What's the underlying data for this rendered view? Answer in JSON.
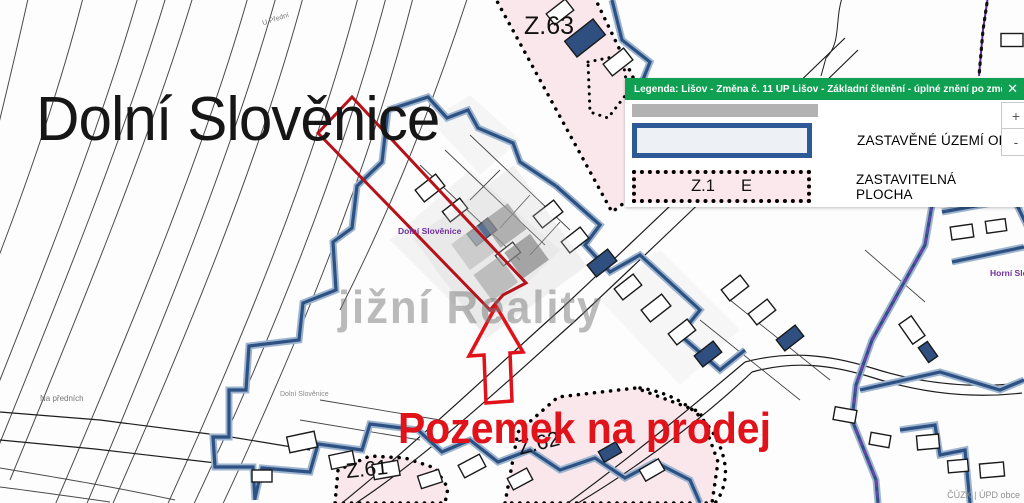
{
  "map": {
    "title_label": "Dolní Slověnice",
    "for_sale_text": "Pozemek na prodej",
    "watermark_text": "jižní Reality",
    "attribution": "ČÚZK | ÚPD obce",
    "labels": {
      "u_predni": "U Přední",
      "na_prednich": "Na předních",
      "village_purple": "Dolní Slověnice",
      "village_gray": "Dolní Slověnice",
      "horni": "Horní Slo"
    },
    "zones": {
      "z63": "Z.63",
      "z62": "Z.62",
      "z61": "Z.61"
    }
  },
  "legend": {
    "title": "Legenda: Lišov - Změna č. 11 ÚP Lišov - Základní členění - úplné znění po změně č. 1-11",
    "close_icon": "✕",
    "items": [
      {
        "label": "ZASTAVĚNÉ ÚZEMÍ OB"
      },
      {
        "zone_code": "Z.1",
        "zone_letter": "E",
        "label": "ZASTAVITELNÁ PLOCHA"
      }
    ]
  },
  "zoom_controls": {
    "zoom_in": "+",
    "zoom_out": "-"
  },
  "colors": {
    "legend_header_green": "#0FA052",
    "built_boundary_blue": "#2D5183",
    "zone_pink": "#FAE7EC",
    "parcel_red": "#B5121B",
    "highlight_red": "#E0121A",
    "cadastre_purple": "#5F2DA0"
  }
}
